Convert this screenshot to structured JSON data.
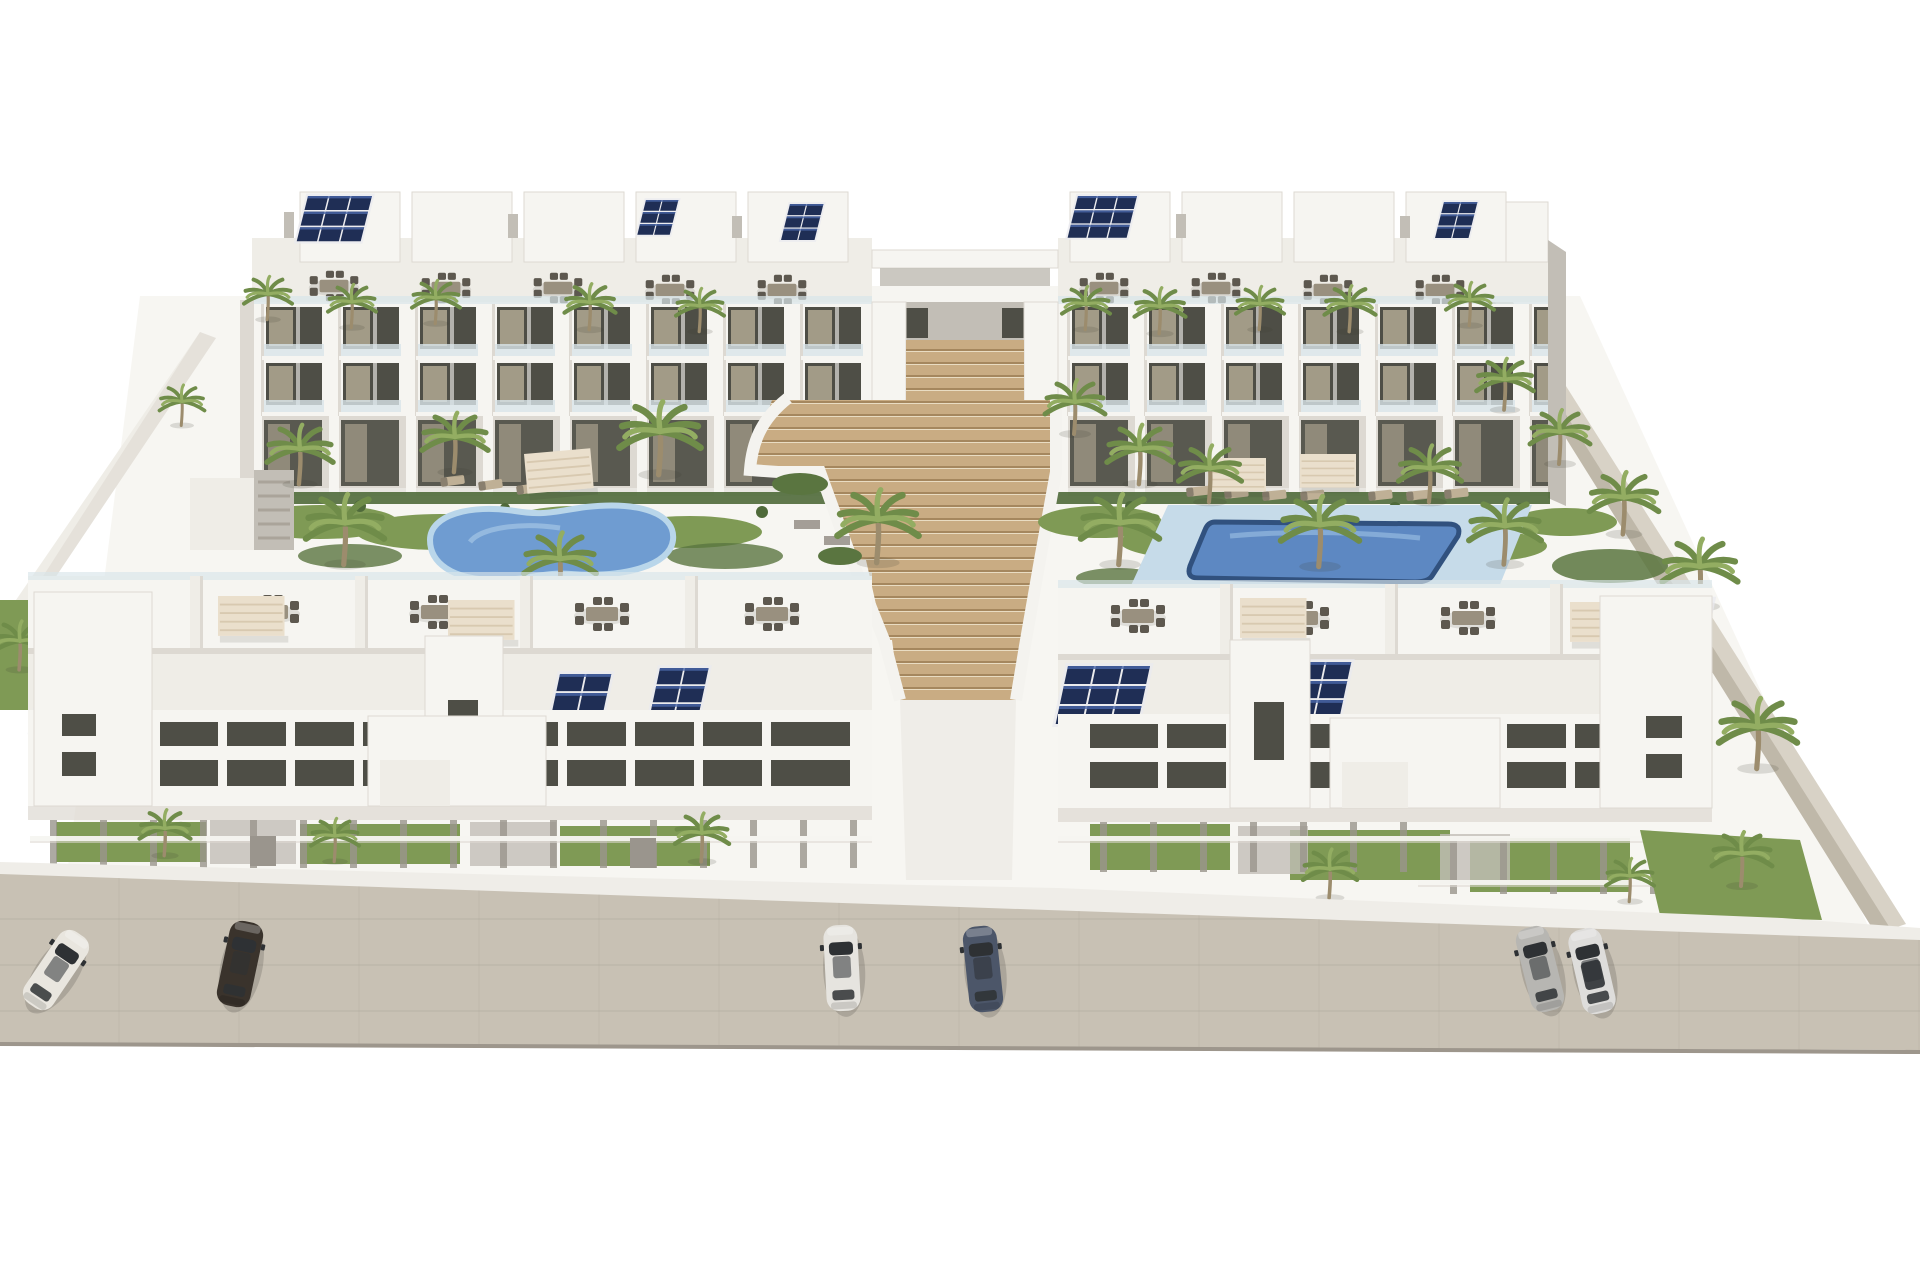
{
  "scene": {
    "type": "architectural-3d-rendering",
    "subject": "Aerial view of a white modern apartment complex: two rear residential blocks, a curved cascading central staircase, landscaped courtyard with two swimming pools, a front row of terraced blocks with rooftop dining terraces and solar panels, and a street with parked cars",
    "background": "#ffffff"
  },
  "palette": {
    "building_white": "#f6f5f1",
    "roof_deck": "#efede7",
    "building_shade": "#ddd9d2",
    "building_dark_shade": "#c2beb6",
    "window_dark": "#4e4e46",
    "window_warm": "#c7bca3",
    "glass_rail": "#d9e5ea",
    "solar_panel": "#1f2e55",
    "solar_panel_light": "#4a66a8",
    "step_tan": "#c9ac83",
    "step_line": "#a5875e",
    "step_highlight": "#e9dcc2",
    "grass": "#7f9a55",
    "grass_dark": "#5a7540",
    "hedge": "#4f6a3a",
    "palm_green": "#6f8c49",
    "palm_light": "#93ad62",
    "palm_trunk": "#9c8c6d",
    "pool_deck": "#c6dbe9",
    "street": "#c8c1b4",
    "sidewalk": "#efede8",
    "furniture_mid": "#99907f",
    "furniture_dark": "#5d584f",
    "furniture_tan": "#bfb096",
    "pergola": "#eadfcc",
    "fence_gray": "#9a958d",
    "wall_beige": "#d8d2c6",
    "car_glass": "#2e3134"
  },
  "buildings": {
    "rear_blocks": 2,
    "front_blocks": 2,
    "stories": 3,
    "features": [
      "rooftop penthouses",
      "solar panel arrays",
      "glass balcony railings",
      "rooftop dining sets",
      "pergola canopies",
      "private street-side gardens"
    ]
  },
  "courtyard": {
    "pools": 2,
    "left_pool": {
      "shape": "kidney",
      "water_color": "#6f9cd1",
      "rim_color": "#b9d6ea"
    },
    "right_pool": {
      "shape": "rectangular",
      "water_color": "#5d88c2",
      "rim_color": "#31517e",
      "deck_color": "#c6dbe9"
    },
    "staircase": {
      "style": "curved cascading steps",
      "color": "#c9ac83"
    },
    "vegetation": [
      "palm trees",
      "shrubs",
      "lawn patches"
    ]
  },
  "street": {
    "surface_color": "#c8c1b4",
    "edge_color": "#9d968c",
    "parked_cars": 6
  },
  "cars": [
    {
      "label": "white-sedan",
      "color": "#e9e6df"
    },
    {
      "label": "dark-brown-sedan",
      "color": "#3a332c"
    },
    {
      "label": "white-hatchback",
      "color": "#e6e4df"
    },
    {
      "label": "dark-blue-sedan",
      "color": "#4c5669"
    },
    {
      "label": "silver-suv",
      "color": "#b7b6b2"
    },
    {
      "label": "white-suv",
      "color": "#dedddb"
    }
  ]
}
